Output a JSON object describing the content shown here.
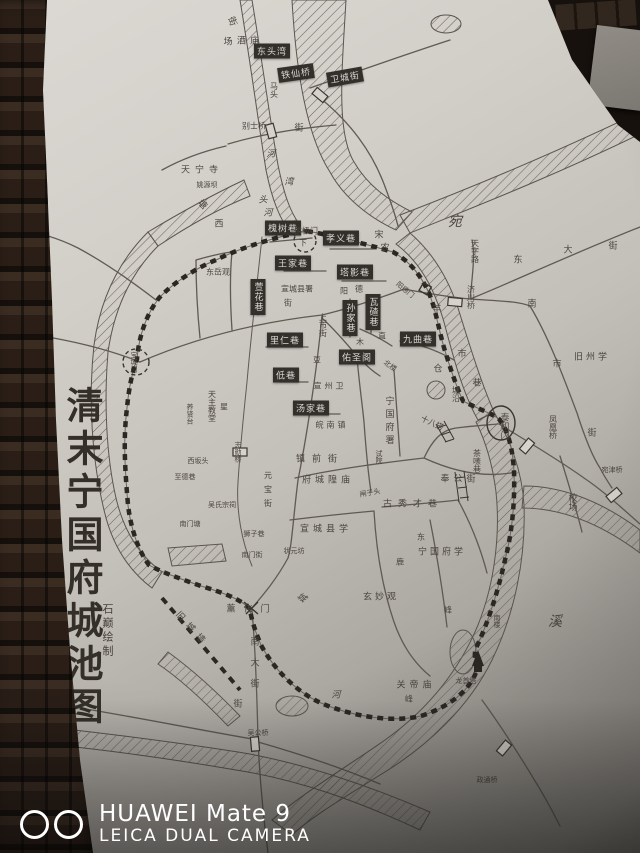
{
  "map": {
    "title": "清末宁国府城池图",
    "credit": "石巅绘制",
    "boxed_labels": [
      {
        "t": "东头湾",
        "x": 272,
        "y": 51
      },
      {
        "t": "铁仙桥",
        "x": 296,
        "y": 73,
        "r": -8
      },
      {
        "t": "卫城街",
        "x": 345,
        "y": 77,
        "r": -10
      },
      {
        "t": "槐树巷",
        "x": 283,
        "y": 228
      },
      {
        "t": "孝义巷",
        "x": 341,
        "y": 238
      },
      {
        "t": "王家巷",
        "x": 293,
        "y": 263
      },
      {
        "t": "塔影巷",
        "x": 355,
        "y": 272
      },
      {
        "t": "萱花巷",
        "x": 258,
        "y": 297,
        "v": 1
      },
      {
        "t": "里仁巷",
        "x": 285,
        "y": 340
      },
      {
        "t": "低巷",
        "x": 286,
        "y": 375
      },
      {
        "t": "孙家巷",
        "x": 350,
        "y": 318,
        "v": 1
      },
      {
        "t": "瓦碴巷",
        "x": 373,
        "y": 312,
        "v": 1
      },
      {
        "t": "佑圣阁",
        "x": 357,
        "y": 357
      },
      {
        "t": "九曲巷",
        "x": 418,
        "y": 339
      },
      {
        "t": "汤家巷",
        "x": 311,
        "y": 408
      }
    ],
    "labels": [
      {
        "t": "街",
        "x": 233,
        "y": 21,
        "r": 70
      },
      {
        "t": "场",
        "x": 228,
        "y": 41
      },
      {
        "t": "酒庙",
        "x": 250,
        "y": 40,
        "ls": 4
      },
      {
        "t": "马头",
        "x": 274,
        "y": 90,
        "v": 1,
        "s": 8
      },
      {
        "t": "别士桥",
        "x": 254,
        "y": 126,
        "s": 8
      },
      {
        "t": "街",
        "x": 299,
        "y": 127
      },
      {
        "t": "河",
        "x": 271,
        "y": 153,
        "i": 1
      },
      {
        "t": "湾",
        "x": 289,
        "y": 181,
        "i": 1
      },
      {
        "t": "头",
        "x": 263,
        "y": 199,
        "i": 1
      },
      {
        "t": "河",
        "x": 268,
        "y": 212,
        "i": 1
      },
      {
        "t": "天宁寺",
        "x": 202,
        "y": 169,
        "ls": 5
      },
      {
        "t": "姚源坝",
        "x": 207,
        "y": 185,
        "s": 7
      },
      {
        "t": "塘",
        "x": 203,
        "y": 204,
        "r": 45
      },
      {
        "t": "西",
        "x": 219,
        "y": 223
      },
      {
        "t": "东岳观",
        "x": 218,
        "y": 272,
        "s": 8
      },
      {
        "t": "拱极门",
        "x": 306,
        "y": 231,
        "s": 8
      },
      {
        "t": "宋",
        "x": 379,
        "y": 234
      },
      {
        "t": "农",
        "x": 385,
        "y": 247
      },
      {
        "t": "下",
        "x": 303,
        "y": 243,
        "s": 8
      },
      {
        "t": "宛",
        "x": 455,
        "y": 221,
        "s": 14,
        "i": 1
      },
      {
        "t": "天字路",
        "x": 475,
        "y": 251,
        "v": 1,
        "s": 8
      },
      {
        "t": "东",
        "x": 518,
        "y": 259
      },
      {
        "t": "大",
        "x": 568,
        "y": 249
      },
      {
        "t": "街",
        "x": 613,
        "y": 245
      },
      {
        "t": "济川桥",
        "x": 471,
        "y": 297,
        "v": 1,
        "s": 8
      },
      {
        "t": "南",
        "x": 532,
        "y": 303
      },
      {
        "t": "市",
        "x": 557,
        "y": 363
      },
      {
        "t": "旧州学",
        "x": 592,
        "y": 356,
        "ls": 3
      },
      {
        "t": "羊",
        "x": 437,
        "y": 308
      },
      {
        "t": "市",
        "x": 462,
        "y": 353
      },
      {
        "t": "巷",
        "x": 477,
        "y": 382
      },
      {
        "t": "仓",
        "x": 438,
        "y": 368
      },
      {
        "t": "塘沿",
        "x": 456,
        "y": 394,
        "v": 1,
        "s": 8
      },
      {
        "t": "阳",
        "x": 344,
        "y": 291,
        "s": 8
      },
      {
        "t": "德",
        "x": 359,
        "y": 289,
        "s": 8
      },
      {
        "t": "街",
        "x": 288,
        "y": 303,
        "s": 8
      },
      {
        "t": "宣城县署",
        "x": 297,
        "y": 289,
        "s": 8
      },
      {
        "t": "上市街",
        "x": 323,
        "y": 325,
        "v": 1,
        "s": 8
      },
      {
        "t": "木",
        "x": 360,
        "y": 342,
        "s": 8
      },
      {
        "t": "直",
        "x": 382,
        "y": 336,
        "s": 8
      },
      {
        "t": "豆",
        "x": 317,
        "y": 360,
        "s": 8
      },
      {
        "t": "北楼",
        "x": 390,
        "y": 366,
        "s": 7,
        "r": 35
      },
      {
        "t": "宣州卫",
        "x": 330,
        "y": 386,
        "s": 8,
        "ls": 3
      },
      {
        "t": "皖南镇",
        "x": 332,
        "y": 425,
        "s": 8,
        "ls": 3
      },
      {
        "t": "宁国府署",
        "x": 389,
        "y": 422,
        "v": 1,
        "ls": 4
      },
      {
        "t": "试院",
        "x": 379,
        "y": 457,
        "v": 1,
        "s": 7
      },
      {
        "t": "镇前街",
        "x": 320,
        "y": 458,
        "ls": 7
      },
      {
        "t": "府城隍庙",
        "x": 328,
        "y": 479,
        "ls": 4
      },
      {
        "t": "奉公街",
        "x": 460,
        "y": 478,
        "ls": 4
      },
      {
        "t": "元宝街",
        "x": 268,
        "y": 492,
        "v": 1,
        "s": 8,
        "ls": 6
      },
      {
        "t": "闸子头",
        "x": 370,
        "y": 493,
        "r": -10,
        "s": 7
      },
      {
        "t": "古秀才巷",
        "x": 413,
        "y": 503,
        "ls": 6
      },
      {
        "t": "宣城县学",
        "x": 326,
        "y": 528,
        "ls": 4
      },
      {
        "t": "状元坊",
        "x": 294,
        "y": 551,
        "s": 7
      },
      {
        "t": "南门街",
        "x": 252,
        "y": 555,
        "s": 7
      },
      {
        "t": "狮子巷",
        "x": 254,
        "y": 534,
        "s": 7
      },
      {
        "t": "南门塘",
        "x": 190,
        "y": 524,
        "s": 7
      },
      {
        "t": "天主教堂",
        "x": 212,
        "y": 406,
        "v": 1,
        "s": 8
      },
      {
        "t": "养贤台",
        "x": 190,
        "y": 414,
        "v": 1,
        "s": 7
      },
      {
        "t": "星",
        "x": 224,
        "y": 407,
        "s": 8
      },
      {
        "t": "志勋桥",
        "x": 238,
        "y": 452,
        "v": 1,
        "s": 7
      },
      {
        "t": "西坂头",
        "x": 198,
        "y": 461,
        "s": 7
      },
      {
        "t": "至德巷",
        "x": 185,
        "y": 477,
        "s": 7
      },
      {
        "t": "吴氏宗祠",
        "x": 222,
        "y": 505,
        "s": 7
      },
      {
        "t": "旧城墙",
        "x": 193,
        "y": 629,
        "r": 48,
        "ls": 6
      },
      {
        "t": "薰化门",
        "x": 252,
        "y": 608,
        "ls": 8
      },
      {
        "t": "南大街",
        "x": 254,
        "y": 668,
        "v": 1,
        "ls": 12
      },
      {
        "t": "街",
        "x": 238,
        "y": 703
      },
      {
        "t": "吴公桥",
        "x": 258,
        "y": 733,
        "s": 7
      },
      {
        "t": "河",
        "x": 336,
        "y": 694,
        "i": 1
      },
      {
        "t": "城",
        "x": 302,
        "y": 597,
        "i": 1,
        "r": 35
      },
      {
        "t": "东",
        "x": 421,
        "y": 537,
        "s": 8
      },
      {
        "t": "鹿",
        "x": 400,
        "y": 562,
        "s": 8
      },
      {
        "t": "宁国府学",
        "x": 442,
        "y": 551,
        "ls": 3
      },
      {
        "t": "玄妙观",
        "x": 381,
        "y": 596,
        "ls": 3
      },
      {
        "t": "峰",
        "x": 448,
        "y": 610,
        "s": 8
      },
      {
        "t": "十八搭",
        "x": 432,
        "y": 423,
        "r": 25,
        "s": 8
      },
      {
        "t": "泰和门",
        "x": 504,
        "y": 426,
        "v": 1
      },
      {
        "t": "茶嗉巷",
        "x": 477,
        "y": 461,
        "v": 1,
        "s": 8
      },
      {
        "t": "凤凰桥",
        "x": 553,
        "y": 427,
        "v": 1,
        "s": 8
      },
      {
        "t": "街",
        "x": 592,
        "y": 432
      },
      {
        "t": "宛津桥",
        "x": 612,
        "y": 470,
        "s": 7
      },
      {
        "t": "校场",
        "x": 572,
        "y": 502,
        "v": 1
      },
      {
        "t": "南楼",
        "x": 497,
        "y": 621,
        "v": 1,
        "s": 7
      },
      {
        "t": "溪",
        "x": 555,
        "y": 621,
        "s": 14,
        "i": 1
      },
      {
        "t": "关帝庙",
        "x": 416,
        "y": 684,
        "ls": 4
      },
      {
        "t": "峰",
        "x": 409,
        "y": 699,
        "s": 8
      },
      {
        "t": "龙首塔",
        "x": 466,
        "y": 681,
        "s": 7
      },
      {
        "t": "政通桥",
        "x": 487,
        "y": 780,
        "s": 7
      },
      {
        "t": "阳德门",
        "x": 405,
        "y": 290,
        "r": 40,
        "s": 7
      },
      {
        "t": "宝城门",
        "x": 134,
        "y": 362,
        "v": 1,
        "s": 7
      }
    ]
  },
  "watermark": {
    "icon": "camera-lenses-icon",
    "line1": "HUAWEI Mate 9",
    "line2": "LEICA DUAL CAMERA"
  },
  "colors": {
    "ink": "#4a453e",
    "map_line": "#5f5a52",
    "wall_dash": "#2b2824",
    "label_bg": "#33302c",
    "label_fg": "#dad6d0",
    "brick": "#2a1e17",
    "watermark": "#ffffff"
  }
}
